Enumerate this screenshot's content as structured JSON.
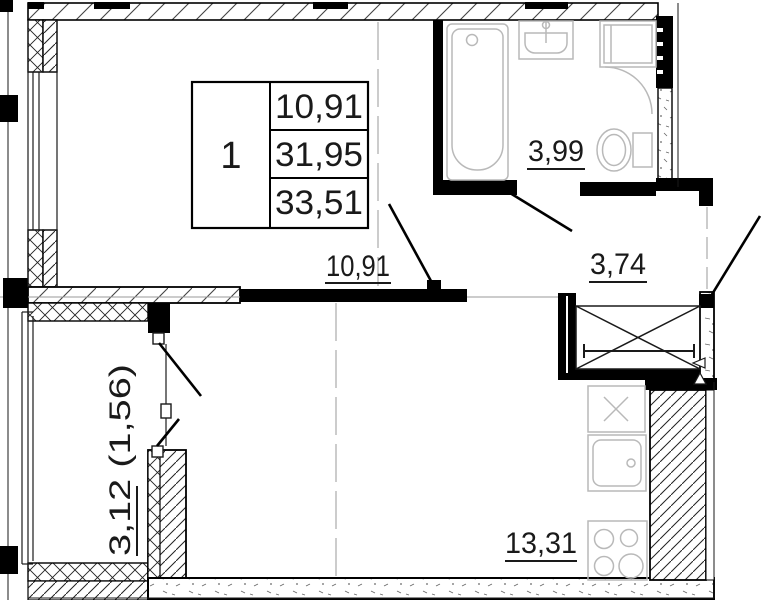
{
  "title": "apartment floor plan",
  "legend": {
    "unit": "1",
    "area_living": "10,91",
    "area_apartment": "31,95",
    "area_total": "33,51"
  },
  "labels": {
    "room": "10,91",
    "bathroom": "3,99",
    "hallway": "3,74",
    "kitchen": "13,31",
    "balcony": "3,12 (1,56)"
  },
  "colors": {
    "walls": "#000000",
    "fixtures": "#b9b9b9",
    "axis": "#9a9a9a",
    "background": "#ffffff"
  }
}
